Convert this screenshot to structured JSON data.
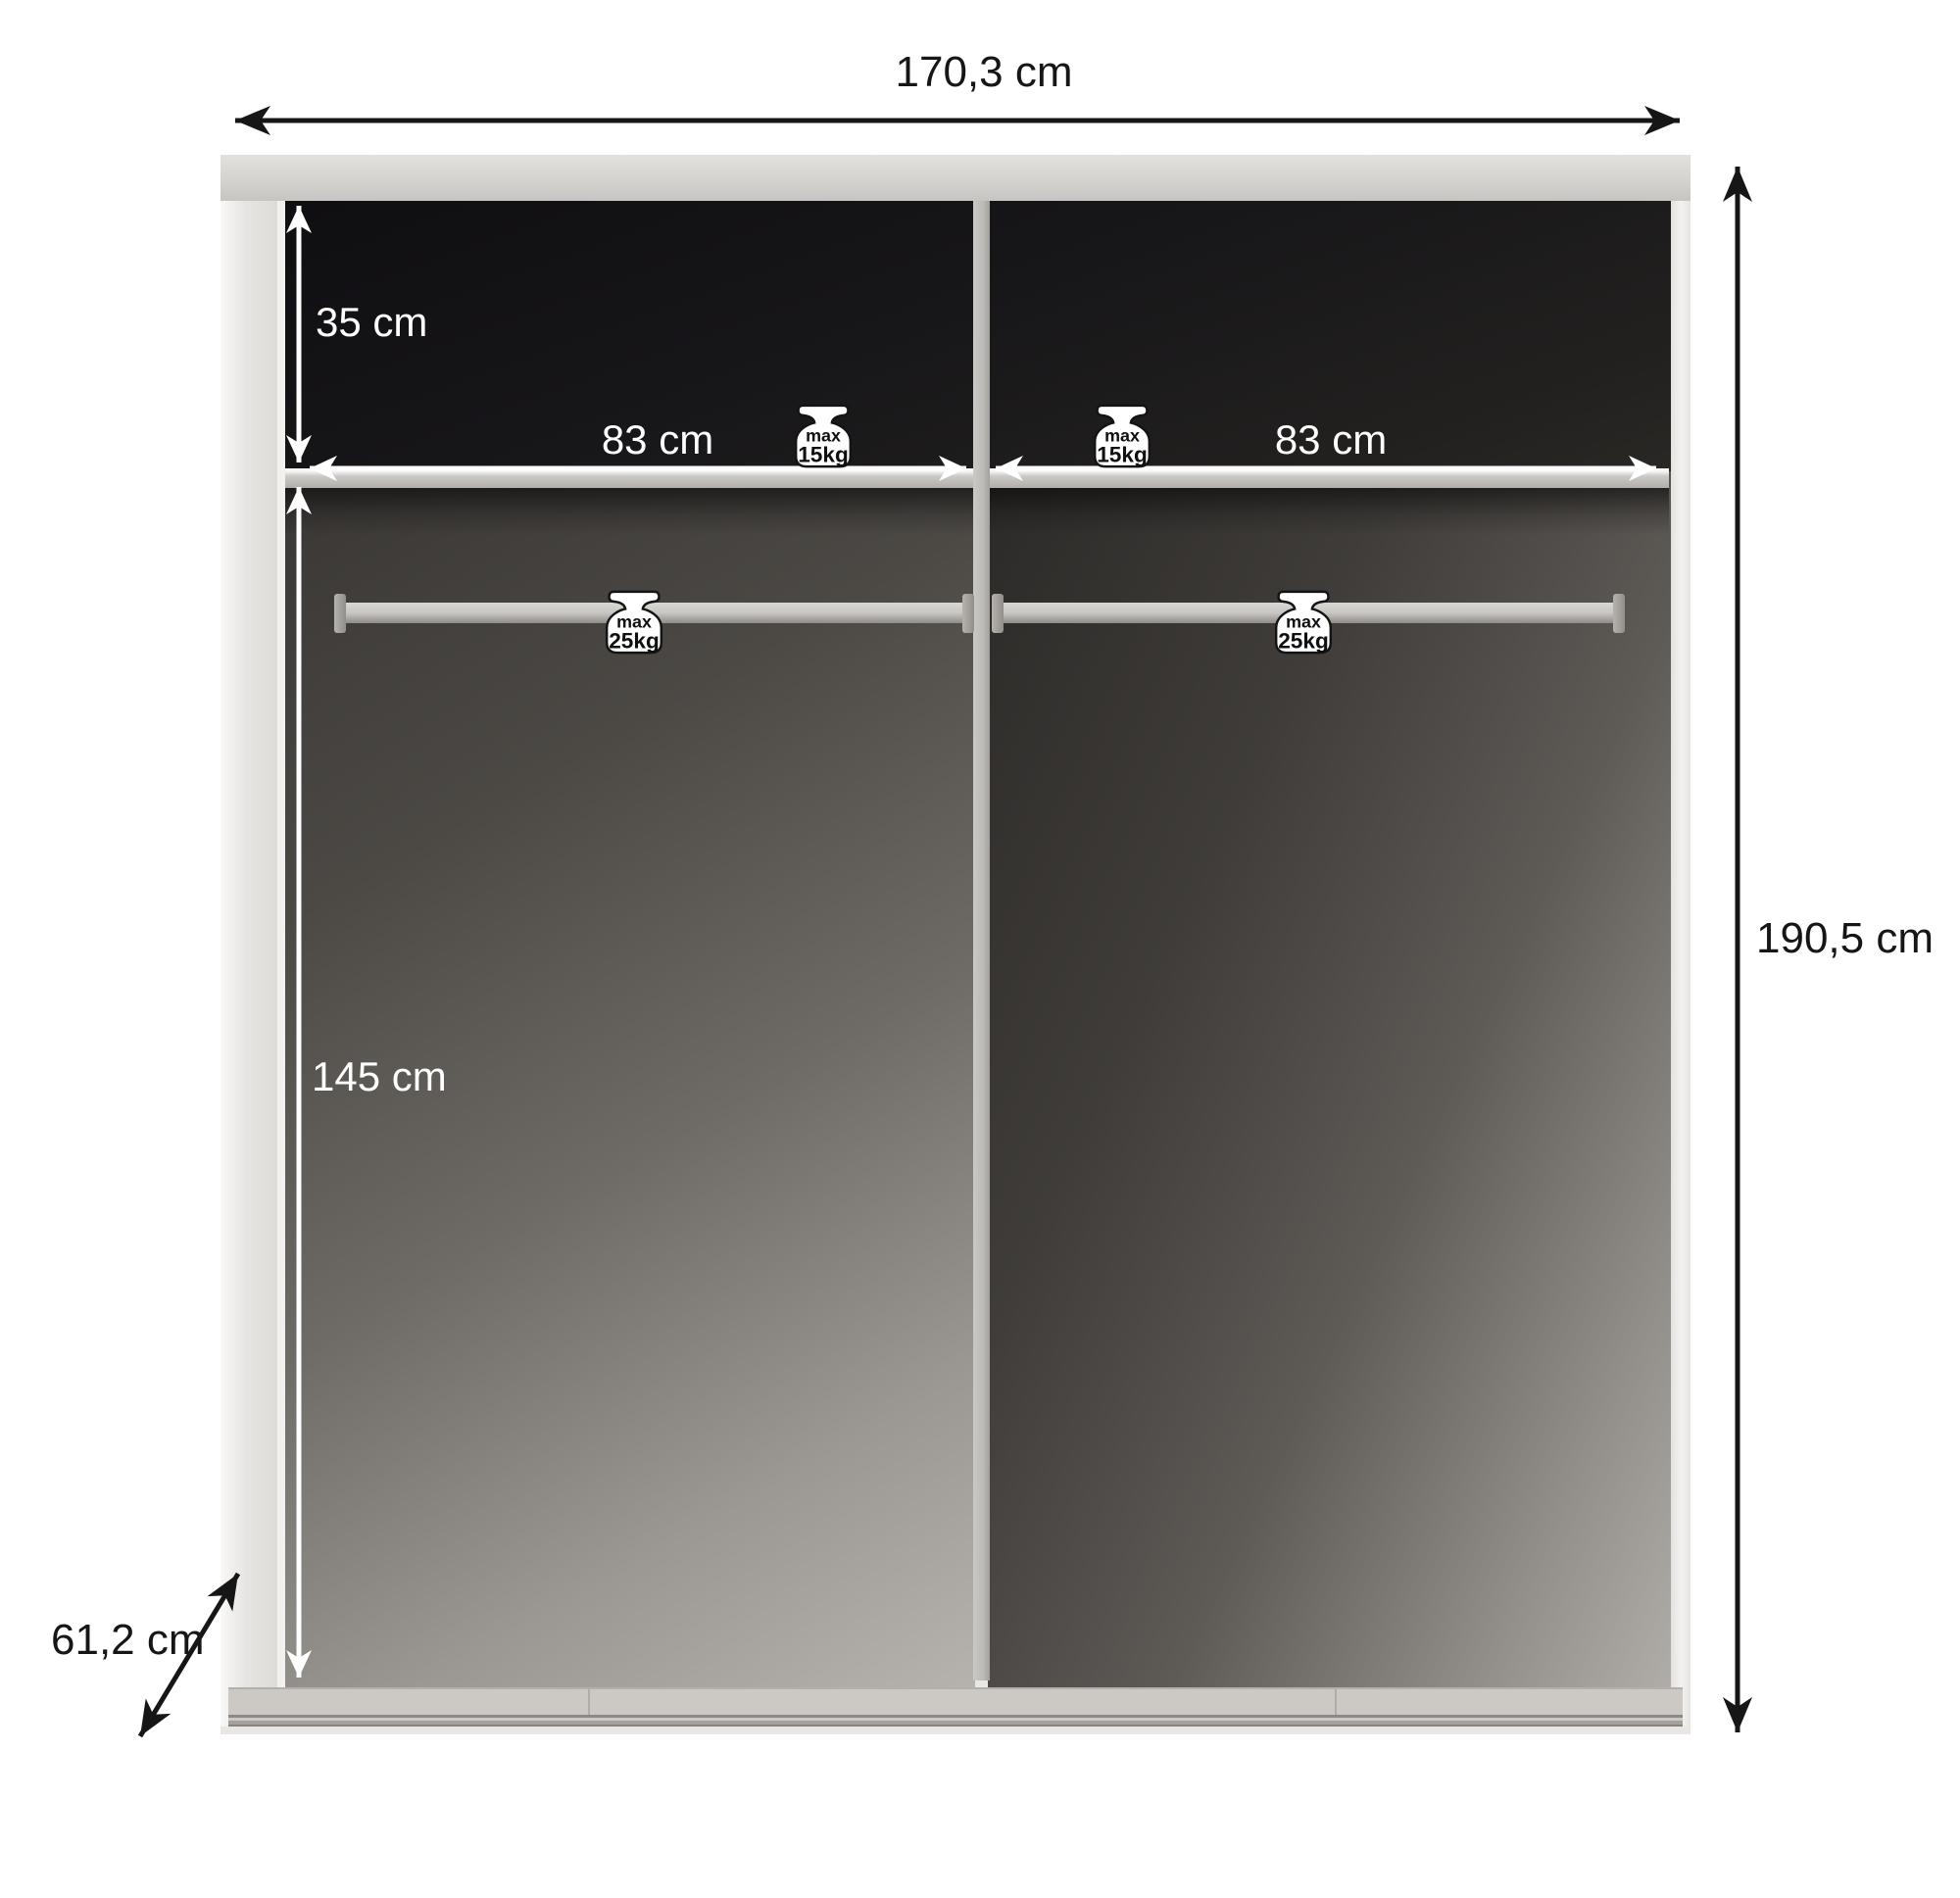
{
  "diagram": {
    "kind": "wardrobe-interior-dimension-drawing",
    "labels": {
      "width": "170,3 cm",
      "height": "190,5 cm",
      "depth": "61,2 cm",
      "upper_compartment": "35 cm",
      "lower_compartment": "145 cm",
      "shelf_left": "83 cm",
      "shelf_right": "83 cm"
    },
    "badges": {
      "shelf_left": {
        "line1": "max",
        "line2": "15kg"
      },
      "shelf_right": {
        "line1": "max",
        "line2": "15kg"
      },
      "rail_left": {
        "line1": "max",
        "line2": "25kg"
      },
      "rail_right": {
        "line1": "max",
        "line2": "25kg"
      }
    },
    "colors": {
      "annotation_black": "#161616",
      "annotation_white": "#ffffff",
      "carcass_light": "#eae8e5",
      "interior_dark": "#17161a",
      "shelf_gray": "#cbc9c5"
    }
  }
}
